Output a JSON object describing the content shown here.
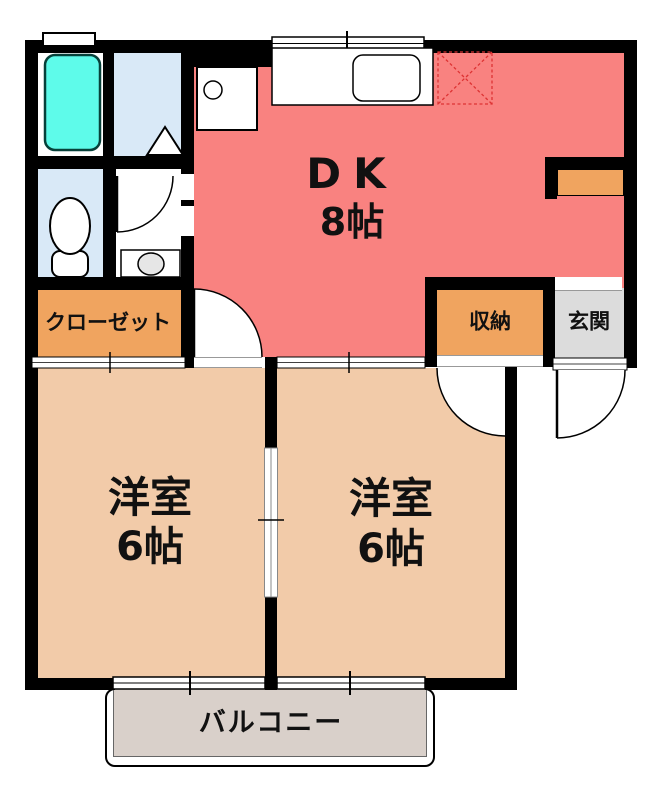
{
  "plan": {
    "title": "apartment-floor-plan",
    "rooms": {
      "dk": {
        "name": "DK",
        "size": "8帖"
      },
      "western_room_1": {
        "name": "洋室",
        "size": "6帖"
      },
      "western_room_2": {
        "name": "洋室",
        "size": "6帖"
      },
      "closet": {
        "name": "クローゼット"
      },
      "storage": {
        "name": "収納"
      },
      "entrance": {
        "name": "玄関"
      },
      "balcony": {
        "name": "バルコニー"
      }
    },
    "fixtures": [
      "bathtub",
      "toilet",
      "washbasin",
      "washing-machine-pan",
      "kitchen-sink-counter",
      "refrigerator-space",
      "wall-shelf",
      "bath-door-triangle",
      "door-swing-arcs",
      "sliding-windows"
    ],
    "colors": {
      "dk": "#f98280",
      "room": "#f2cba9",
      "closet": "#f0a45f",
      "entrance": "#dcdcdc",
      "balcony": "#d9d0ca",
      "bathtub": "#5efbea",
      "wet_area": "#d9e9f7",
      "wall": "#000000",
      "fridge_dash": "#dd3333"
    }
  }
}
